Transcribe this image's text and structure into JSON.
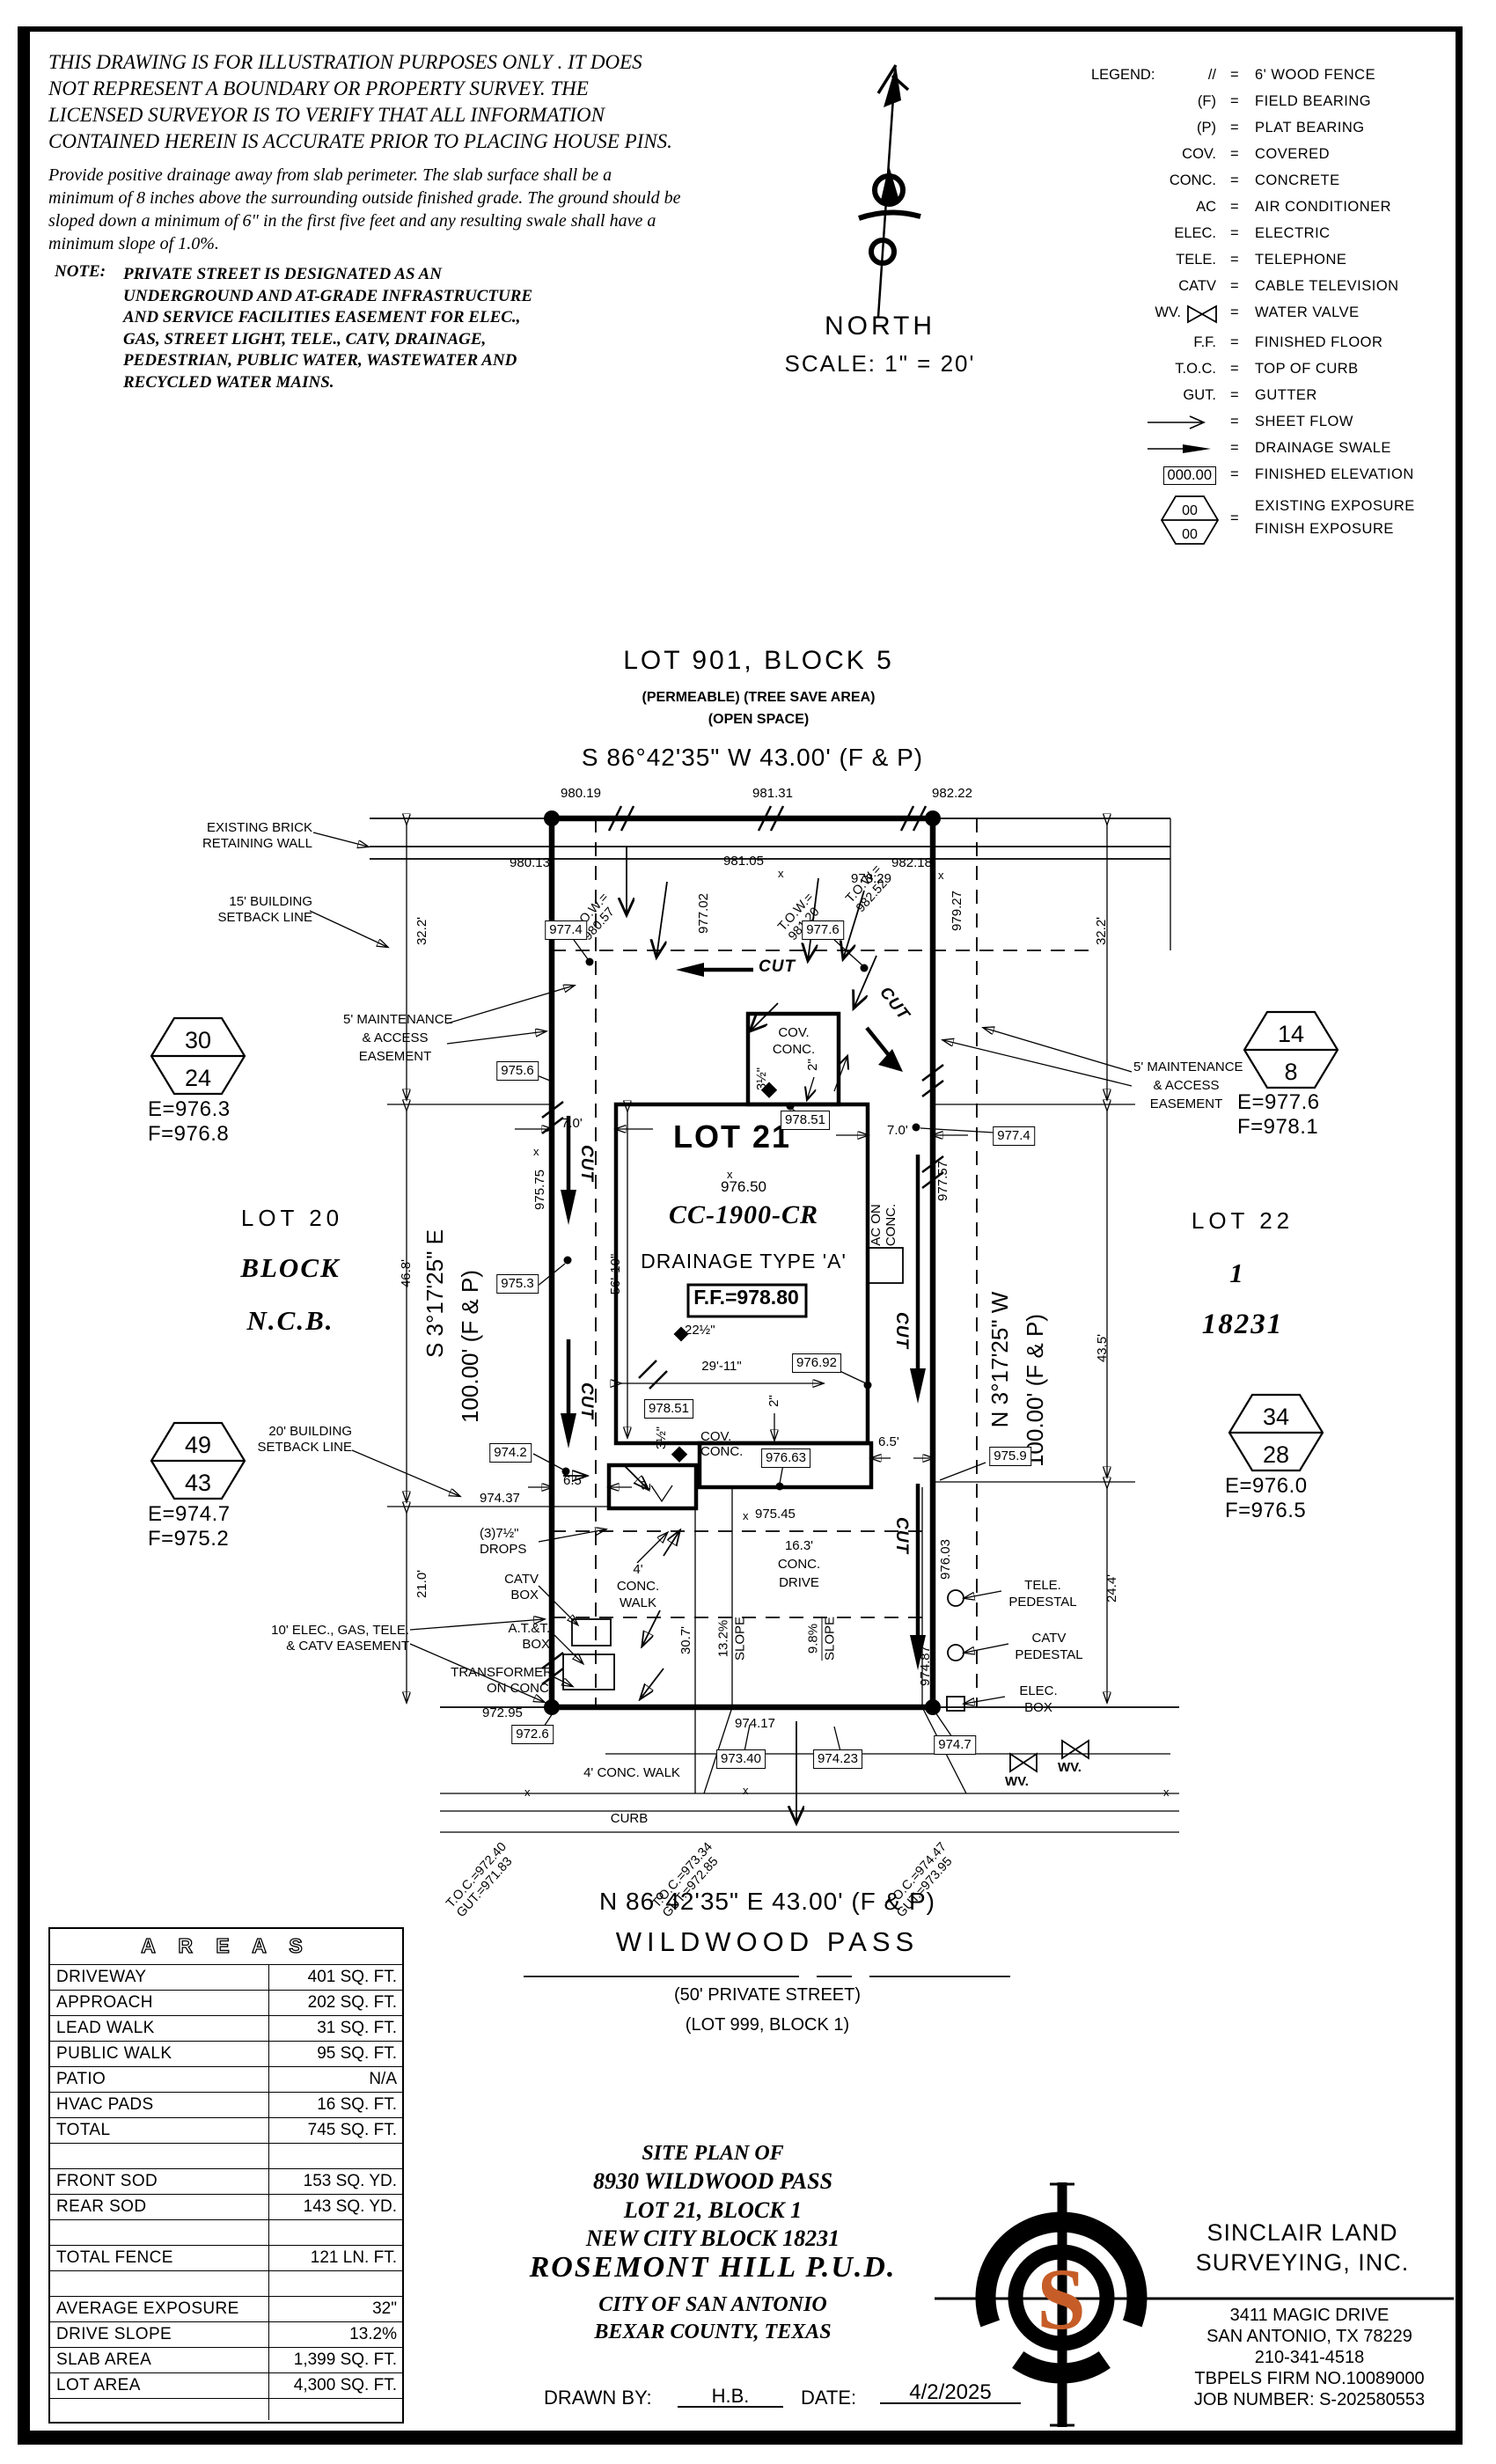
{
  "sheet": {
    "disclaimer": [
      "THIS DRAWING IS FOR ILLUSTRATION PURPOSES ONLY . IT DOES",
      "NOT REPRESENT A BOUNDARY OR PROPERTY SURVEY. THE",
      "LICENSED SURVEYOR IS TO VERIFY THAT ALL INFORMATION",
      "CONTAINED HEREIN IS ACCURATE PRIOR TO PLACING HOUSE PINS."
    ],
    "drainage_note": [
      "Provide positive drainage away from slab perimeter. The slab surface shall be a",
      "minimum of 8 inches above the surrounding outside finished grade. The ground should be",
      "sloped down a minimum of 6\" in the first five feet and any resulting swale shall have a",
      "minimum slope of 1.0%."
    ],
    "note_label": "NOTE:",
    "note_lines": [
      "PRIVATE STREET IS DESIGNATED AS AN",
      "UNDERGROUND AND AT-GRADE INFRASTRUCTURE",
      "AND SERVICE FACILITIES EASEMENT FOR ELEC.,",
      "GAS, STREET LIGHT, TELE., CATV, DRAINAGE,",
      "PEDESTRIAN, PUBLIC WATER, WASTEWATER AND",
      "RECYCLED WATER MAINS."
    ],
    "north_label": "NORTH",
    "scale_label": "SCALE: 1\" = 20'"
  },
  "legend": {
    "title": "LEGEND:",
    "eq": "=",
    "rows": [
      {
        "s": "//",
        "d": "6' WOOD FENCE"
      },
      {
        "s": "(F)",
        "d": "FIELD BEARING"
      },
      {
        "s": "(P)",
        "d": "PLAT BEARING"
      },
      {
        "s": "COV.",
        "d": "COVERED"
      },
      {
        "s": "CONC.",
        "d": "CONCRETE"
      },
      {
        "s": "AC",
        "d": "AIR CONDITIONER"
      },
      {
        "s": "ELEC.",
        "d": "ELECTRIC"
      },
      {
        "s": "TELE.",
        "d": "TELEPHONE"
      },
      {
        "s": "CATV",
        "d": "CABLE TELEVISION"
      },
      {
        "s": "WV.",
        "d": "WATER VALVE"
      },
      {
        "s": "F.F.",
        "d": "FINISHED FLOOR"
      },
      {
        "s": "T.O.C.",
        "d": "TOP OF CURB"
      },
      {
        "s": "GUT.",
        "d": "GUTTER"
      },
      {
        "s": "",
        "d": "SHEET FLOW"
      },
      {
        "s": "",
        "d": "DRAINAGE SWALE"
      },
      {
        "s": "000.00",
        "d": "FINISHED ELEVATION"
      },
      {
        "s": "",
        "d": "EXISTING EXPOSURE"
      }
    ],
    "exposure_top": "00",
    "exposure_bottom": "00",
    "exposure_d2": "FINISH EXPOSURE"
  },
  "plan": {
    "lot901": [
      "LOT 901, BLOCK 5",
      "(PERMEABLE) (TREE SAVE AREA)",
      "(OPEN SPACE)"
    ],
    "bearing_top": "S 86°42'35\" W 43.00' (F & P)",
    "bearing_bottom": "N 86°42'35\" E 43.00' (F & P)",
    "bearing_left": [
      "S 3°17'25\" E",
      "100.00' (F & P)"
    ],
    "bearing_right": [
      "N 3°17'25\" W",
      "100.00' (F & P)"
    ],
    "street": [
      "WILDWOOD PASS",
      "(50' PRIVATE STREET)",
      "(LOT 999, BLOCK 1)"
    ],
    "lot20": [
      "LOT 20",
      "BLOCK",
      "N.C.B."
    ],
    "lot22": [
      "LOT 22",
      "1",
      "18231"
    ],
    "lot21": {
      "name": "LOT 21",
      "spot": "976.50",
      "model": "CC-1900-CR",
      "drainage": "DRAINAGE TYPE 'A'",
      "ff": "F.F.=978.80"
    },
    "hex": [
      {
        "t": "30",
        "b": "24",
        "e": "E=976.3",
        "f": "F=976.8"
      },
      {
        "t": "14",
        "b": "8",
        "e": "E=977.6",
        "f": "F=978.1"
      },
      {
        "t": "49",
        "b": "43",
        "e": "E=974.7",
        "f": "F=975.2"
      },
      {
        "t": "34",
        "b": "28",
        "e": "E=976.0",
        "f": "F=976.5"
      }
    ],
    "callouts": {
      "wall": [
        "EXISTING BRICK",
        "RETAINING WALL"
      ],
      "setback15": [
        "15' BUILDING",
        "SETBACK LINE"
      ],
      "maint": [
        "5' MAINTENANCE",
        "& ACCESS",
        "EASEMENT"
      ],
      "setback20": [
        "20' BUILDING",
        "SETBACK LINE"
      ],
      "easement10": [
        "10' ELEC., GAS, TELE.",
        "& CATV EASEMENT"
      ],
      "drops": [
        "(3)7½\"",
        "DROPS"
      ],
      "catv_box": [
        "CATV",
        "BOX"
      ],
      "att_box": [
        "A.T.&T.",
        "BOX"
      ],
      "transformer": [
        "TRANSFORMER",
        "ON CONC."
      ],
      "tele_ped": [
        "TELE.",
        "PEDESTAL"
      ],
      "catv_ped": [
        "CATV",
        "PEDESTAL"
      ],
      "elec_box": [
        "ELEC.",
        "BOX"
      ],
      "cov_conc": [
        "COV.",
        "CONC."
      ],
      "ac": [
        "AC ON",
        "CONC."
      ],
      "walk_lot": [
        "4'",
        "CONC.",
        "WALK"
      ],
      "drive": [
        "16.3'",
        "CONC.",
        "DRIVE"
      ],
      "walk_street": "4' CONC. WALK",
      "curb": "CURB",
      "wv": "WV.",
      "cut": "CUT",
      "xmark": "x"
    },
    "elev_boxed": [
      "977.4",
      "977.6",
      "975.6",
      "975.3",
      "978.51",
      "977.4",
      "976.92",
      "978.51",
      "974.2",
      "975.9",
      "976.63",
      "972.6",
      "973.40",
      "974.23",
      "974.7"
    ],
    "elev_free": [
      "980.19",
      "981.31",
      "982.22",
      "980.13",
      "981.05",
      "982.18",
      "978.29",
      "974.37",
      "974.17",
      "972.95",
      "975.45"
    ],
    "elev_vert": [
      "977.02",
      "979.27",
      "977.57",
      "975.75",
      "976.03",
      "974.87"
    ],
    "tow": [
      [
        "T.O.W.=",
        "980.57"
      ],
      [
        "T.O.W.=",
        "981.20"
      ],
      [
        "T.O.W.=",
        "982.52"
      ]
    ],
    "toc": [
      [
        "T.O.C.=",
        "972.40",
        "GUT.=",
        "971.83"
      ],
      [
        "T.O.C.=",
        "973.34",
        "GUT.=",
        "972.85"
      ],
      [
        "T.O.C.=",
        "974.47",
        "GUT.=",
        "973.95"
      ]
    ],
    "dims": {
      "w_top": "32.2'",
      "w_mid": "46.8'",
      "w_bot": "21.0'",
      "e_top": "32.2'",
      "e_mid": "43.5'",
      "e_bot": "24.4'",
      "gap_w": "7.0'",
      "gap_e": "7.0'",
      "house_depth": "56'-10\"",
      "house_width": "29'-11\"",
      "eave": "22½\"",
      "patio_a": "3½\"",
      "patio_b": "2\"",
      "porch_b": "2\"",
      "garage_a": "3½\"",
      "garage_b": "2'",
      "garage_gap": "6.5'",
      "porch_gap": "6.5'",
      "walk_len": "30.7'",
      "slope_drive": [
        "13.2%",
        "SLOPE"
      ],
      "slope_approach": [
        "9.8%",
        "SLOPE"
      ]
    }
  },
  "areas": {
    "title": "A R E A S",
    "rows": [
      {
        "l": "DRIVEWAY",
        "v": "401 SQ. FT."
      },
      {
        "l": "APPROACH",
        "v": "202 SQ. FT."
      },
      {
        "l": "LEAD WALK",
        "v": "31 SQ. FT."
      },
      {
        "l": "PUBLIC WALK",
        "v": "95 SQ. FT."
      },
      {
        "l": "PATIO",
        "v": "N/A"
      },
      {
        "l": "HVAC PADS",
        "v": "16 SQ. FT."
      },
      {
        "l": "TOTAL",
        "v": "745 SQ. FT."
      },
      {
        "l": "",
        "v": ""
      },
      {
        "l": "FRONT SOD",
        "v": "153 SQ. YD."
      },
      {
        "l": "REAR SOD",
        "v": "143 SQ. YD."
      },
      {
        "l": "",
        "v": ""
      },
      {
        "l": "TOTAL FENCE",
        "v": "121 LN. FT."
      },
      {
        "l": "",
        "v": ""
      },
      {
        "l": "AVERAGE EXPOSURE",
        "v": "32\""
      },
      {
        "l": "DRIVE SLOPE",
        "v": "13.2%"
      },
      {
        "l": "SLAB AREA",
        "v": "1,399 SQ. FT."
      },
      {
        "l": "LOT AREA",
        "v": "4,300 SQ. FT."
      },
      {
        "l": "",
        "v": ""
      }
    ]
  },
  "title_block": {
    "lines": [
      "SITE PLAN OF",
      "8930 WILDWOOD PASS",
      "LOT 21, BLOCK 1",
      "NEW CITY BLOCK 18231",
      "ROSEMONT HILL P.U.D.",
      "CITY OF SAN ANTONIO",
      "BEXAR COUNTY, TEXAS"
    ],
    "drawn_by_label": "DRAWN BY:",
    "drawn_by": "H.B.",
    "date_label": "DATE:",
    "date": "4/2/2025"
  },
  "surveyor": {
    "name": [
      "SINCLAIR LAND",
      "SURVEYING, INC."
    ],
    "monogram": "S",
    "address": [
      "3411 MAGIC DRIVE",
      "SAN ANTONIO, TX 78229",
      "210-341-4518",
      "TBPELS FIRM NO.10089000",
      "JOB NUMBER: S-202580553"
    ],
    "accent_color": "#c65d28"
  }
}
